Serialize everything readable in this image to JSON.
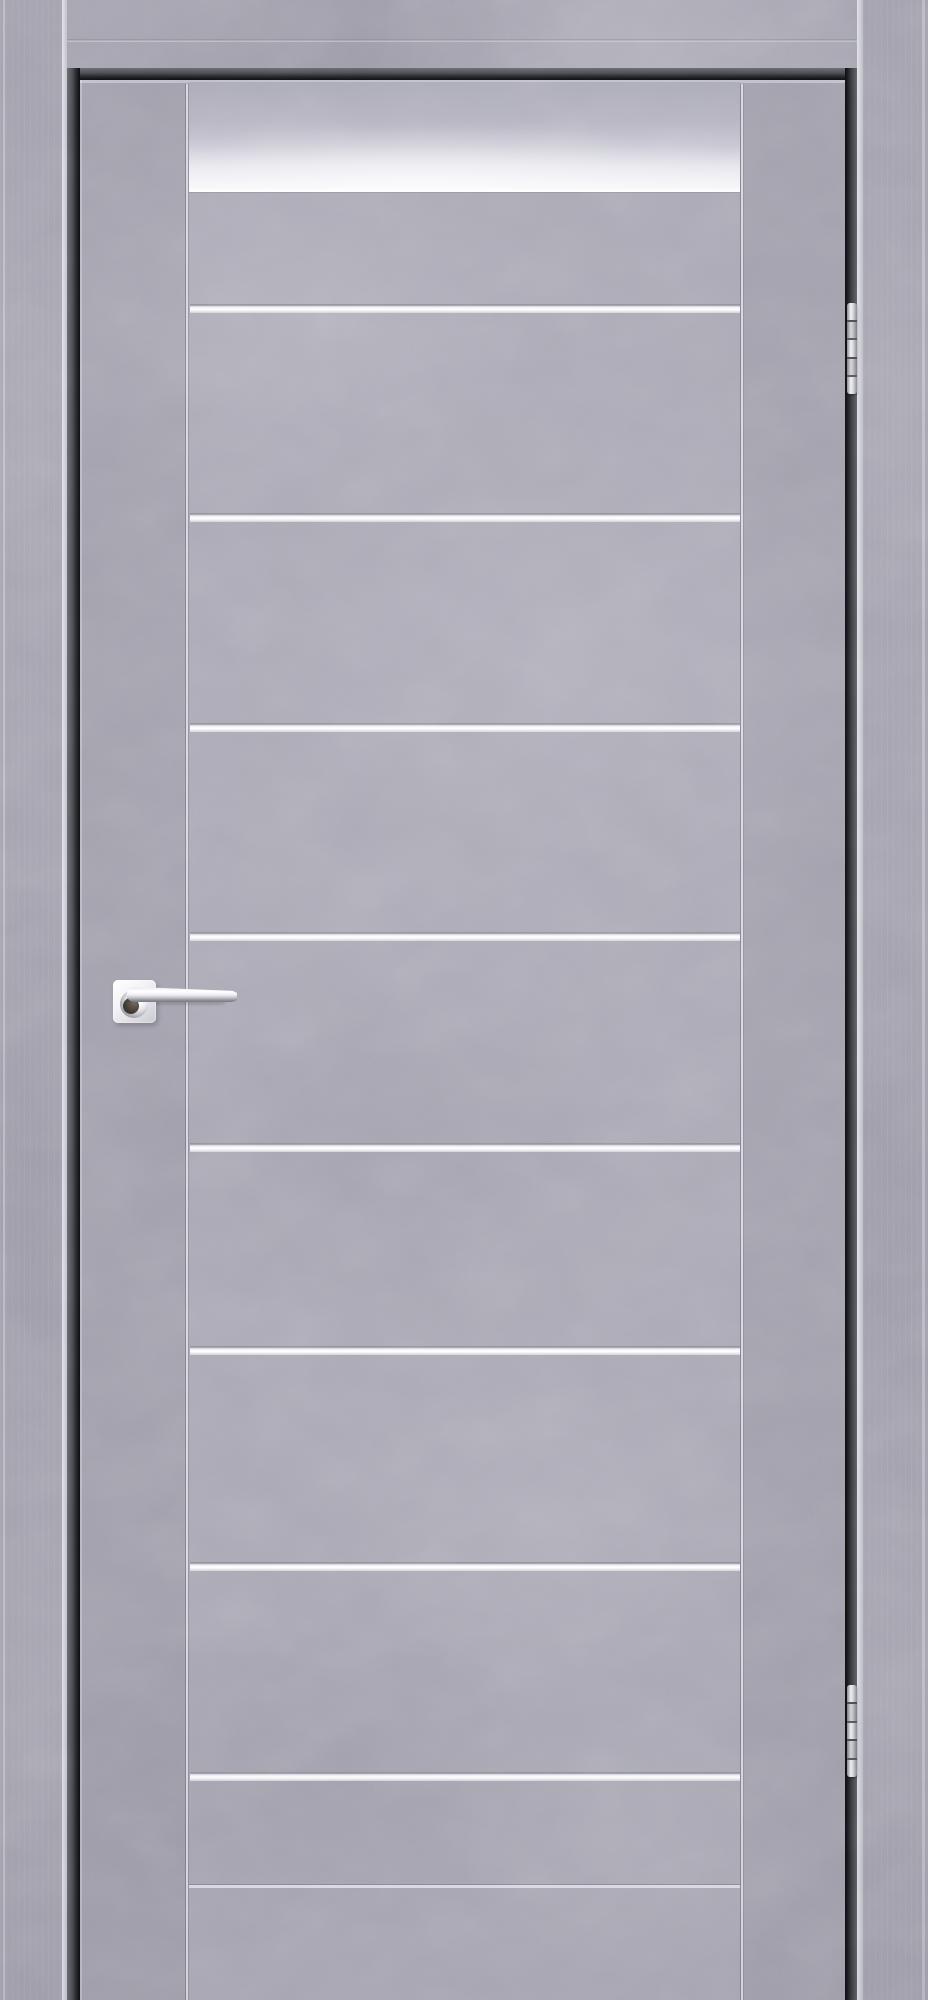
{
  "scene": {
    "subject": "interior door product photo",
    "style": "gray concrete-texture door leaf in matching gray frame with dark reveal, frosted white glass band near the top, horizontal aluminum inlay strips, chrome square-rose lever handle on the left stile, two chrome barrel hinges on the right edge"
  },
  "canvas": {
    "width": 928,
    "height": 2000
  },
  "palette": {
    "base_gray": "#a3a2ae",
    "casing_gray": "#a2a1ad",
    "stile_gray": "#a09fab",
    "panel_gray": "#a8a7b3",
    "reveal_dark": "#3f4044",
    "reveal_black": "#101013",
    "edge_highlight": "#d0d2dc",
    "strip_white": "#f5f5f8",
    "glass_light": "#e9e9f0",
    "chrome_light": "#fdfdfe",
    "chrome_dark": "#77777e",
    "handle_shadow": "#38322e"
  },
  "leaf": {
    "x": 80,
    "y": 80,
    "w": 765,
    "h": 1920,
    "stile_line_left_x": 185,
    "stile_line_right_x": 740,
    "panel_x": 189,
    "panel_w": 551,
    "glass": {
      "y": 82,
      "h": 110
    },
    "strips": {
      "count": 8,
      "x": 190,
      "w": 550,
      "height": 9,
      "y_tops": [
        304,
        513,
        723,
        932,
        1143,
        1346,
        1562,
        1772
      ]
    },
    "bottom_groove_y": 1884
  },
  "hardware": {
    "handle": {
      "type": "chrome lever on square rose",
      "rose": {
        "x": 113,
        "y": 980,
        "size": 43
      },
      "collar": {
        "x": 120,
        "y": 990,
        "size": 28
      },
      "lever": {
        "x": 127,
        "y": 987,
        "len": 110,
        "th": 15
      },
      "shadow": {
        "x": 133,
        "y": 1001,
        "len": 92,
        "th": 3
      }
    },
    "hinges": {
      "type": "barrel hinge, 5 knuckles",
      "x": 847,
      "w": 10,
      "knuckles": 5,
      "items": [
        {
          "y": 303,
          "h": 91
        },
        {
          "y": 1685,
          "h": 92
        }
      ]
    }
  }
}
